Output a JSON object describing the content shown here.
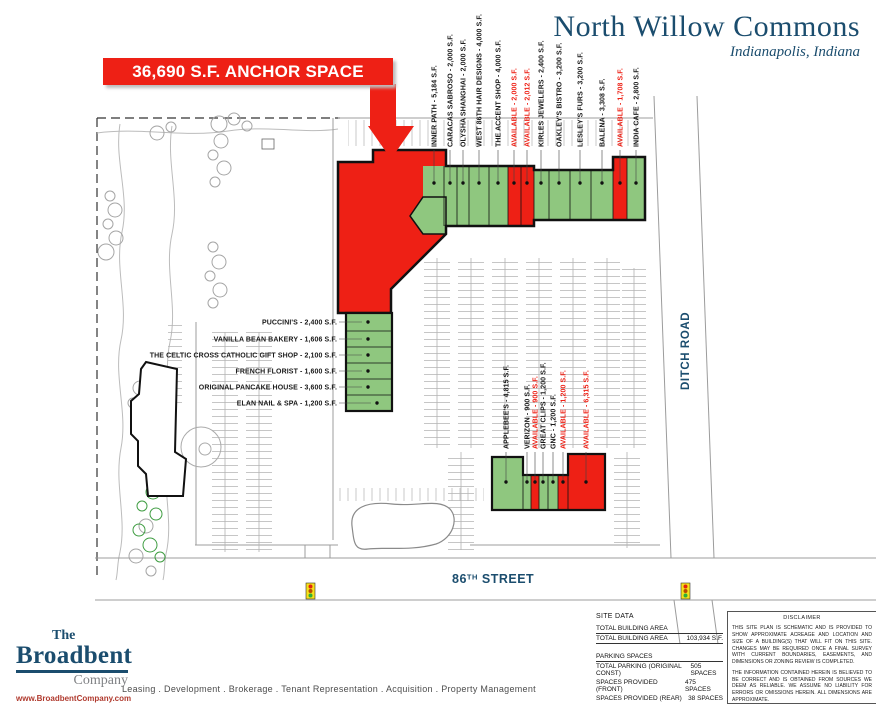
{
  "colors": {
    "available_red": "#ee2015",
    "tenant_green": "#8fc77f",
    "brand_blue": "#1b4d6e",
    "logo_gray": "#808285",
    "url_red": "#b03a2e"
  },
  "header": {
    "title": "North Willow Commons",
    "subtitle": "Indianapolis, Indiana"
  },
  "callout": {
    "text": "36,690 S.F. ANCHOR SPACE AVAILABLE"
  },
  "plan": {
    "top_labels": [
      "INNER PATH - 5,184 S.F.",
      "CARACAS SABROSO - 2,000 S.F.",
      "OLYSHA SHANGHAI - 2,000 S.F.",
      "WEST 86TH HAIR DESIGNS - 4,000 S.F.",
      "THE ACCENT SHOP - 4,000 S.F.",
      "AVAILABLE - 2,000 S.F.",
      "AVAILABLE - 2,012 S.F.",
      "KIRLES JEWELERS - 2,400 S.F.",
      "OAKLEY'S BISTRO - 3,200 S.F.",
      "LESLEY'S FURS - 3,200 S.F.",
      "BALENA - 3,308 S.F.",
      "AVAILABLE - 1,708 S.F.",
      "INDIA CAFE - 2,800 S.F."
    ],
    "left_labels": [
      "PUCCINI'S - 2,400 S.F.",
      "VANILLA BEAN BAKERY - 1,606 S.F.",
      "THE CELTIC CROSS CATHOLIC GIFT SHOP - 2,100 S.F.",
      "FRENCH FLORIST - 1,600 S.F.",
      "ORIGINAL PANCAKE HOUSE - 3,600 S.F.",
      "ELAN NAIL & SPA - 1,200 S.F."
    ],
    "mid_labels": [
      "APPLEBEE'S - 4,815 S.F.",
      "VERIZON - 900 S.F.",
      "AVAILABLE - 900 S.F.",
      "GREAT CLIPS - 1,200 S.F.",
      "GNC - 1,200 S.F.",
      "AVAILABLE - 1,200 S.F.",
      "AVAILABLE - 6,315 S.F."
    ],
    "roads": {
      "ditch": "DITCH ROAD",
      "street86": {
        "num": "86",
        "sup": "TH",
        "rest": " STREET"
      }
    }
  },
  "footer": {
    "logo": {
      "the": "The",
      "name": "Broadbent",
      "company": "Company",
      "url": "www.BroadbentCompany.com"
    },
    "services": "Leasing . Development . Brokerage . Tenant Representation . Acquisition . Property Management",
    "site_data": {
      "title": "SITE DATA",
      "building_header": "TOTAL BUILDING AREA",
      "building_row": [
        "TOTAL BUILDING AREA",
        "103,934 S.F."
      ],
      "parking_header": "PARKING SPACES",
      "parking_rows": [
        [
          "TOTAL PARKING (ORIGINAL CONST)",
          "505 SPACES"
        ],
        [
          "SPACES PROVIDED  (FRONT)",
          "475 SPACES"
        ],
        [
          "SPACES PROVIDED  (REAR)",
          "38 SPACES"
        ]
      ]
    },
    "disclaimer": {
      "title": "DISCLAIMER",
      "p1": "THIS SITE PLAN IS SCHEMATIC AND IS PROVIDED TO SHOW APPROXIMATE ACREAGE AND LOCATION AND SIZE OF A BUILDING(S) THAT WILL FIT ON THIS SITE.  CHANGES MAY BE REQUIRED ONCE A FINAL SURVEY WITH CURRENT BOUNDARIES, EASEMENTS, AND DIMENSIONS OR ZONING REVIEW IS COMPLETED.",
      "p2": "THE INFORMATION CONTAINED HEREIN IS BELIEVED TO BE CORRECT AND IS OBTAINED FROM SOURCES WE DEEM AS RELIABLE.  WE ASSUME NO LIABILITY FOR ERRORS OR OMISSIONS HEREIN.  ALL DIMENSIONS ARE APPROXIMATE."
    }
  }
}
